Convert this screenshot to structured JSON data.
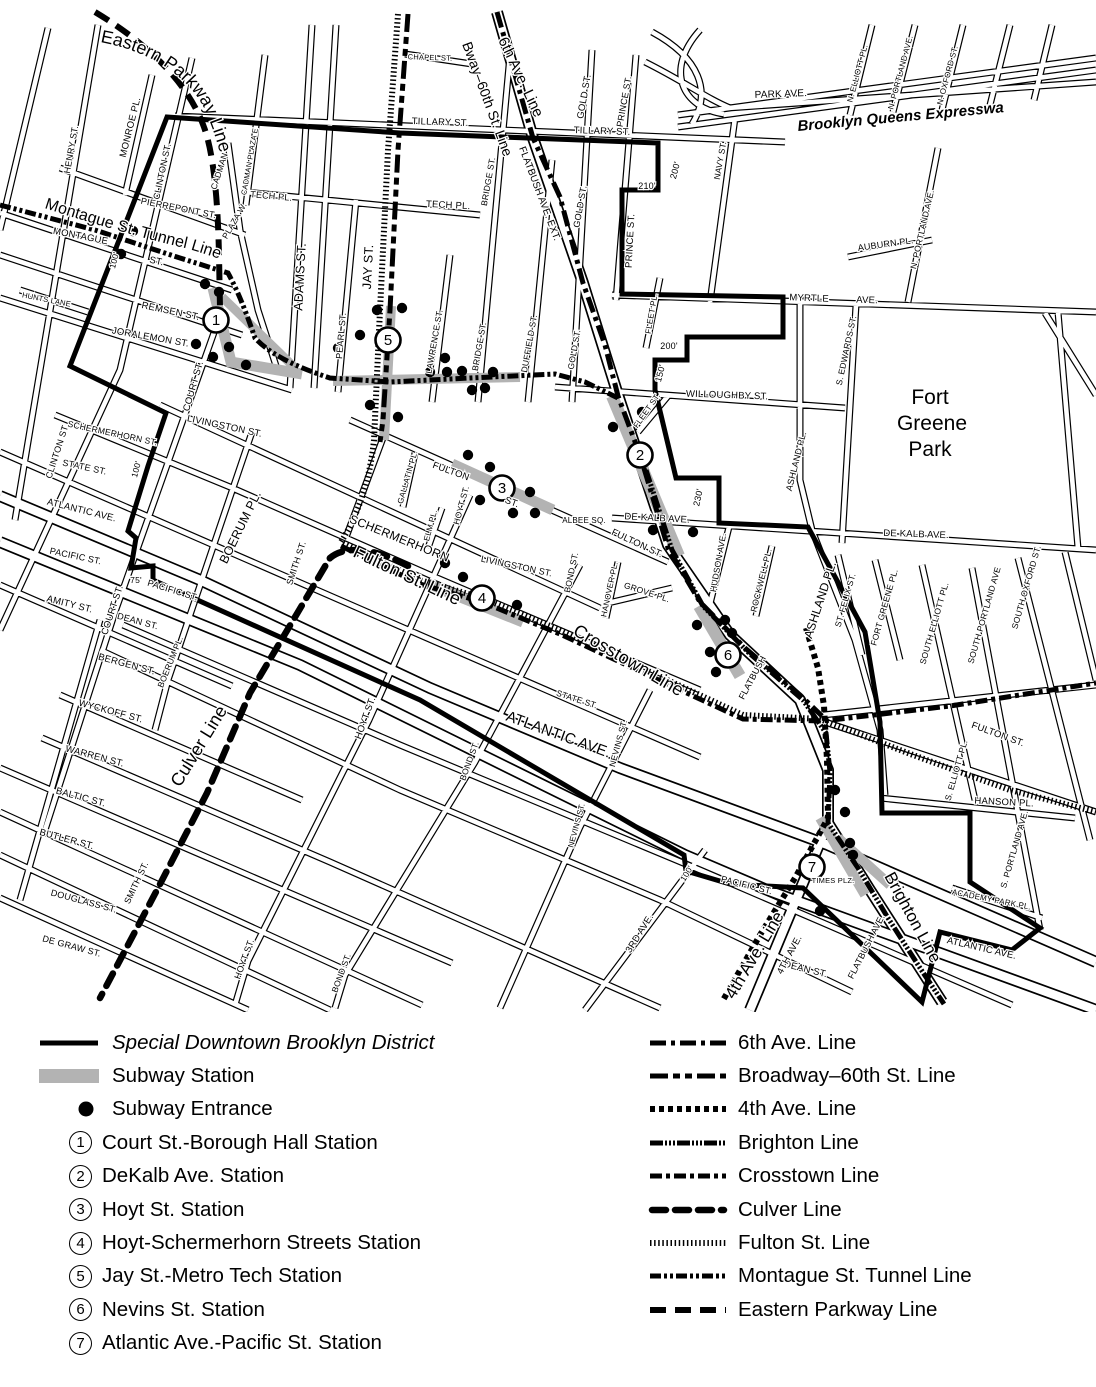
{
  "legend": {
    "district_label": "Special Downtown Brooklyn District",
    "station_label": "Subway Station",
    "entrance_label": "Subway Entrance",
    "stations": [
      {
        "num": "1",
        "label": "Court St.-Borough Hall Station"
      },
      {
        "num": "2",
        "label": "DeKalb Ave. Station"
      },
      {
        "num": "3",
        "label": "Hoyt St. Station"
      },
      {
        "num": "4",
        "label": "Hoyt-Schermerhorn Streets Station"
      },
      {
        "num": "5",
        "label": "Jay St.-Metro Tech Station"
      },
      {
        "num": "6",
        "label": "Nevins St. Station"
      },
      {
        "num": "7",
        "label": "Atlantic Ave.-Pacific St. Station"
      }
    ],
    "lines": [
      {
        "label": "6th Ave. Line",
        "swatch_class": "sw-line l-sixth"
      },
      {
        "label": "Broadway–60th St. Line",
        "swatch_class": "sw-line l-broadway"
      },
      {
        "label": "4th Ave. Line",
        "swatch_class": "sw-line l-fourth"
      },
      {
        "label": "Brighton Line",
        "swatch_class": "sw-line l-brighton"
      },
      {
        "label": "Crosstown Line",
        "swatch_class": "sw-line l-crosstown"
      },
      {
        "label": "Culver Line",
        "swatch_class": "sw-line l-culver"
      },
      {
        "label": "Fulton St. Line",
        "swatch_class": "sw-line l-fulton"
      },
      {
        "label": "Montague St. Tunnel Line",
        "swatch_class": "sw-line l-montague"
      },
      {
        "label": "Eastern Parkway Line",
        "swatch_class": "sw-line l-eastern"
      }
    ]
  },
  "map": {
    "colors": {
      "ink": "#000000",
      "station_gray": "#b3b3b3",
      "background": "#ffffff"
    },
    "park": {
      "line1": "Fort",
      "line2": "Greene",
      "line3": "Park"
    },
    "line_labels": {
      "eastern": "Eastern Parkway Line",
      "montague": "Montague St. Tunnel Line",
      "bway": "Bway–60th St. Line",
      "sixth": "6th Ave. Line",
      "flatbush_ext": "FLATBUSH AVE. EXT.",
      "fulton": "Fulton St. Line",
      "crosstown": "Crosstown Line",
      "culver": "Culver Line",
      "fourth": "4th Ave. Line",
      "brighton": "Brighton Line",
      "bqe": "Brooklyn  Queens  Expressway"
    },
    "stations": [
      [
        "1",
        216,
        320
      ],
      [
        "2",
        640,
        455
      ],
      [
        "3",
        502,
        488
      ],
      [
        "4",
        482,
        598
      ],
      [
        "5",
        388,
        340
      ],
      [
        "6",
        728,
        655
      ],
      [
        "7",
        812,
        867
      ]
    ],
    "entrances": [
      [
        133,
        231
      ],
      [
        121,
        254
      ],
      [
        205,
        284
      ],
      [
        219,
        292
      ],
      [
        196,
        344
      ],
      [
        229,
        347
      ],
      [
        213,
        357
      ],
      [
        246,
        365
      ],
      [
        377,
        310
      ],
      [
        402,
        308
      ],
      [
        360,
        335
      ],
      [
        338,
        348
      ],
      [
        445,
        358
      ],
      [
        447,
        372
      ],
      [
        472,
        390
      ],
      [
        493,
        372
      ],
      [
        370,
        405
      ],
      [
        398,
        417
      ],
      [
        430,
        372
      ],
      [
        462,
        371
      ],
      [
        485,
        388
      ],
      [
        468,
        455
      ],
      [
        490,
        467
      ],
      [
        513,
        513
      ],
      [
        530,
        492
      ],
      [
        535,
        513
      ],
      [
        480,
        500
      ],
      [
        642,
        412
      ],
      [
        613,
        427
      ],
      [
        653,
        530
      ],
      [
        693,
        532
      ],
      [
        463,
        577
      ],
      [
        517,
        605
      ],
      [
        445,
        563
      ],
      [
        697,
        625
      ],
      [
        725,
        620
      ],
      [
        732,
        633
      ],
      [
        710,
        652
      ],
      [
        716,
        672
      ],
      [
        845,
        812
      ],
      [
        850,
        843
      ],
      [
        853,
        855
      ],
      [
        820,
        911
      ],
      [
        835,
        790
      ]
    ],
    "street_labels": [
      [
        "MONROE PL.",
        133,
        128,
        -76,
        9.5
      ],
      [
        "HENRY ST.",
        74,
        150,
        -80,
        9
      ],
      [
        "CLINTON ST.",
        165,
        172,
        -78,
        9
      ],
      [
        "CLINTON ST.",
        60,
        452,
        -72,
        9
      ],
      [
        "PIERREPONT ST.",
        178,
        211,
        11,
        9
      ],
      [
        "MONTAGUE",
        80,
        239,
        11,
        9.5
      ],
      [
        "ST.",
        156,
        264,
        12,
        9.5
      ],
      [
        "HUNTS LANE",
        46,
        302,
        11,
        7.5
      ],
      [
        "REMSEN ST.",
        170,
        314,
        12,
        9.5
      ],
      [
        "JORALEMON ST.",
        150,
        340,
        10,
        9.5
      ],
      [
        "COURT ST.",
        196,
        387,
        -74,
        9.5
      ],
      [
        "COURT ST.",
        115,
        611,
        -72,
        9.5
      ],
      [
        "ADAMS ST.",
        304,
        277,
        -87,
        12.5
      ],
      [
        "JAY ST.",
        372,
        267,
        -87,
        12.5
      ],
      [
        "CADMAN",
        222,
        172,
        -72,
        8.5
      ],
      [
        "PLAZA W.",
        237,
        222,
        -60,
        8.5
      ],
      [
        "CADMAN PLAZA E",
        252,
        162,
        -80,
        7.5
      ],
      [
        "TECH PL.",
        271,
        199,
        5,
        9
      ],
      [
        "TECH PL.",
        448,
        208,
        3,
        9.5
      ],
      [
        "PEARL ST.",
        344,
        336,
        -85,
        9
      ],
      [
        "CHAPEL ST.",
        430,
        60,
        2,
        7.5
      ],
      [
        "TILLARY ST.",
        440,
        125,
        2,
        9.5
      ],
      [
        "TILLARY ST.",
        602,
        134,
        2,
        9.5
      ],
      [
        "GOLD ST.",
        587,
        97,
        -80,
        9.5
      ],
      [
        "GOLD ST.",
        583,
        207,
        -80,
        9
      ],
      [
        "GOLD ST.",
        577,
        350,
        -80,
        8.5
      ],
      [
        "PRINCE ST.",
        627,
        102,
        -80,
        9
      ],
      [
        "PRINCE ST.",
        633,
        241,
        -87,
        9.5
      ],
      [
        "BRIDGE ST.",
        491,
        182,
        -80,
        8.5
      ],
      [
        "BRIDGE ST.",
        482,
        347,
        -80,
        8.5
      ],
      [
        "LAWRENCE ST.",
        437,
        342,
        -80,
        8.5
      ],
      [
        "DUFFIELD ST.",
        532,
        344,
        -80,
        8.5
      ],
      [
        "NAVY ST.",
        723,
        161,
        -80,
        8.5
      ],
      [
        "PARK AVE.",
        781,
        97,
        -2,
        10
      ],
      [
        "N. ELLIOTT PL.",
        860,
        74,
        -75,
        8
      ],
      [
        "N. PORTLAND AVE.",
        903,
        73,
        -75,
        8
      ],
      [
        "N. OXFORD ST.",
        950,
        76,
        -75,
        8
      ],
      [
        "AUBURN PL.",
        886,
        247,
        -8,
        9
      ],
      [
        "N. PORTLAND AVE.",
        925,
        230,
        -77,
        8.5
      ],
      [
        "MYRTLE",
        809,
        301,
        2,
        9.5
      ],
      [
        "AVE.",
        867,
        303,
        2,
        9.5
      ],
      [
        "S. EDWARDS ST.",
        849,
        351,
        -78,
        8.5
      ],
      [
        "FLEET PL.",
        654,
        314,
        -80,
        8
      ],
      [
        "FLEET ST.",
        649,
        412,
        -55,
        8
      ],
      [
        "WILLOUGHBY ST.",
        727,
        398,
        2,
        9.5
      ],
      [
        "ASHLAND PL.",
        799,
        462,
        -76,
        9
      ],
      [
        "ASHLAND PL.",
        824,
        601,
        -72,
        12
      ],
      [
        "DE KALB AVE.",
        657,
        521,
        3,
        9.5
      ],
      [
        "DE KALB AVE.",
        916,
        537,
        2,
        9.5
      ],
      [
        "ALBEE SQ.",
        584,
        523,
        0,
        8
      ],
      [
        "FULTON ST.",
        636,
        546,
        25,
        9.5
      ],
      [
        "FULTON",
        450,
        474,
        20,
        9.5
      ],
      [
        "ST.",
        511,
        505,
        20,
        9.5
      ],
      [
        "HOYT ST.",
        464,
        506,
        -75,
        8.5
      ],
      [
        "GALLATIN PL.",
        410,
        478,
        -74,
        8
      ],
      [
        "ELM PL.",
        433,
        526,
        -75,
        8
      ],
      [
        "HUDSON AVE.",
        721,
        563,
        -80,
        8.5
      ],
      [
        "ROCKWELL PL.",
        764,
        581,
        -76,
        8.5
      ],
      [
        "ST. FELIX ST.",
        848,
        601,
        -74,
        8.5
      ],
      [
        "FORT GREENE PL.",
        887,
        608,
        -74,
        8.5
      ],
      [
        "SOUTH ELLIOTT PL.",
        937,
        624,
        -74,
        8.5
      ],
      [
        "SOUTH PORTLAND AVE",
        987,
        616,
        -74,
        8.5
      ],
      [
        "SOUTH OXFORD ST.",
        1029,
        588,
        -74,
        8.5
      ],
      [
        "GROVE PL.",
        646,
        595,
        18,
        8.5
      ],
      [
        "HANOVER PL.",
        612,
        590,
        -78,
        8
      ],
      [
        "BOND ST.",
        574,
        573,
        -78,
        8.5
      ],
      [
        "BOND ST.",
        472,
        762,
        -70,
        8.5
      ],
      [
        "BOND ST.",
        344,
        974,
        -70,
        8.5
      ],
      [
        "LIVINGSTON ST.",
        224,
        429,
        12,
        9.5
      ],
      [
        "LIVINGSTON ST.",
        516,
        569,
        12,
        9
      ],
      [
        "SCHERMERHORN ST.",
        112,
        436,
        12,
        8.5
      ],
      [
        "SCHERMERHORN",
        398,
        542,
        22,
        12
      ],
      [
        "STATE ST.",
        84,
        470,
        12,
        9
      ],
      [
        "STATE ST.",
        576,
        702,
        18,
        8.5
      ],
      [
        "ATLANTIC AVE.",
        81,
        513,
        14,
        9.5
      ],
      [
        "ATLANTIC AVE.",
        557,
        739,
        20,
        15
      ],
      [
        "ATLANTIC AVE.",
        981,
        951,
        13,
        9.5
      ],
      [
        "PACIFIC ST.",
        75,
        559,
        12,
        9
      ],
      [
        "PACIFIC ST.",
        172,
        593,
        17,
        9
      ],
      [
        "PACIFIC ST.",
        746,
        888,
        14,
        9
      ],
      [
        "AMITY ST.",
        69,
        607,
        14,
        9.5
      ],
      [
        "DEAN ST.",
        137,
        624,
        15,
        9
      ],
      [
        "DEAN ST.",
        805,
        972,
        14,
        9.5
      ],
      [
        "BERGEN ST.",
        126,
        667,
        15,
        9.5
      ],
      [
        "BOERUM PL.",
        244,
        529,
        -64,
        12.5
      ],
      [
        "BOERUM PL.",
        173,
        663,
        -68,
        8.5
      ],
      [
        "SMITH ST.",
        299,
        564,
        -72,
        9
      ],
      [
        "SMITH ST.",
        139,
        884,
        -65,
        9
      ],
      [
        "HOYT ST.",
        368,
        719,
        -70,
        9.5
      ],
      [
        "HOYT ST.",
        247,
        960,
        -70,
        9
      ],
      [
        "WYCKOFF ST.",
        110,
        714,
        15,
        9.5
      ],
      [
        "WARREN ST.",
        94,
        759,
        15,
        9.5
      ],
      [
        "BALTIC ST.",
        80,
        800,
        15,
        9.5
      ],
      [
        "BUTLER ST.",
        66,
        842,
        15,
        9.5
      ],
      [
        "DOUGLASS ST.",
        83,
        904,
        15,
        9
      ],
      [
        "DE GRAW ST.",
        71,
        949,
        15,
        9
      ],
      [
        "NEVINS ST.",
        621,
        744,
        -75,
        8.5
      ],
      [
        "NEVINS ST.",
        579,
        826,
        -75,
        8
      ],
      [
        "3RD AVE.",
        642,
        935,
        -58,
        9.5
      ],
      [
        "4TH AVE.",
        792,
        956,
        -62,
        9.5
      ],
      [
        "TIMES PLZ.",
        833,
        883,
        0,
        7.5
      ],
      [
        "FLATBUSH",
        755,
        679,
        -62,
        9
      ],
      [
        "FLATBUSH AVE.",
        869,
        948,
        -63,
        9
      ],
      [
        "HANSON PL.",
        1004,
        805,
        3,
        9.5
      ],
      [
        "S. ELLIOTT PL.",
        959,
        771,
        -74,
        8.5
      ],
      [
        "S. PORTLAND AVE.",
        1017,
        850,
        -74,
        8.5
      ],
      [
        "ACADEMY PARK PL.",
        991,
        902,
        11,
        8
      ],
      [
        "FULTON ST.",
        997,
        737,
        20,
        9.5
      ],
      [
        "210'",
        647,
        189,
        0,
        9
      ],
      [
        "200'",
        678,
        171,
        -75,
        9
      ],
      [
        "200'",
        669,
        349,
        0,
        9
      ],
      [
        "150'",
        663,
        374,
        -75,
        9
      ],
      [
        "230'",
        701,
        498,
        -78,
        9
      ],
      [
        "100'",
        117,
        261,
        -75,
        8.5
      ],
      [
        "100'",
        139,
        470,
        -75,
        8.5
      ],
      [
        "100'",
        689,
        875,
        -58,
        8.5
      ],
      [
        "75'",
        136,
        583,
        0,
        8.5
      ]
    ]
  }
}
